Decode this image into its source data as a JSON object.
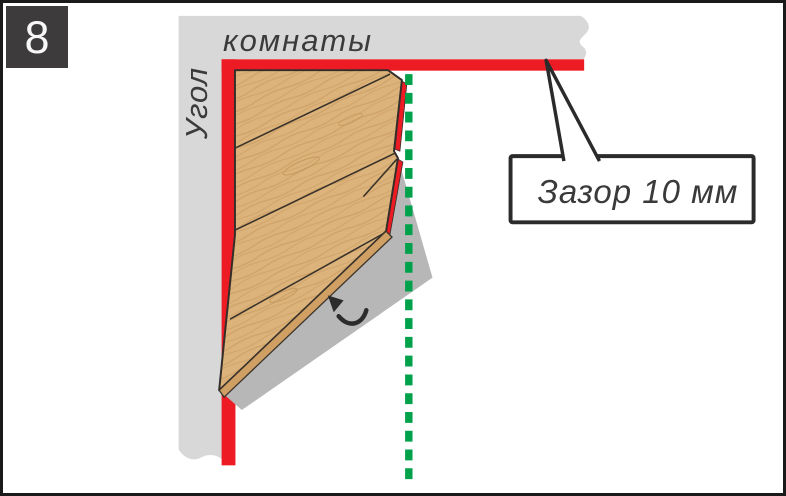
{
  "step_badge": {
    "number": "8"
  },
  "wall_label": {
    "vertical": "Угол",
    "horizontal": "комнаты"
  },
  "callout": {
    "label": "Зазор 10 мм"
  },
  "colors": {
    "gap_red": "#ED1C24",
    "guide_green": "#00A14B",
    "wood": "#DCB37A",
    "wood_edge": "#CF9F63",
    "wall_gray": "#D8D8D8",
    "shadow_gray": "#B7B7B7",
    "ink": "#332E29",
    "badge_bg": "#3D3B3C"
  },
  "icons": {
    "tilt_arrow": "curved-arrow-up-left",
    "guide_line": "vertical-dashed-cut-line"
  }
}
